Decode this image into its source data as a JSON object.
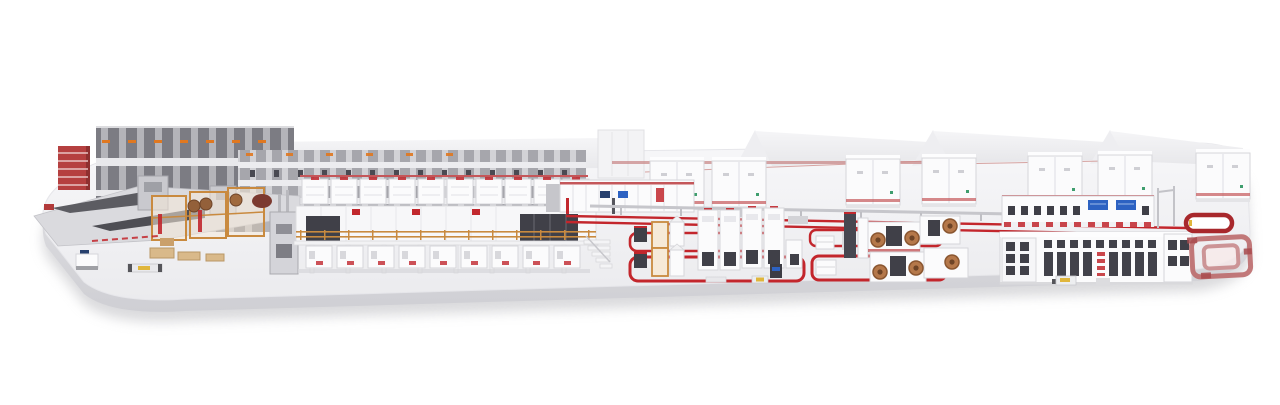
{
  "meta": {
    "description": "3D isometric render of a complete end-to-end industrial production line displayed on a white rounded platform",
    "background": "#ffffff"
  },
  "colors": {
    "platform_top": "#f3f3f5",
    "platform_side": "#e0e0e4",
    "platform_shadow": "#b5b5ba",
    "machine_white": "#fbfbfc",
    "machine_outline": "#d6d6da",
    "panel_dark": "#404048",
    "accent_red": "#c1272d",
    "muted_red": "#c4575a",
    "floor_red": "#c3262c",
    "rack_dark": "#84848a",
    "rack_light": "#b4b4b9",
    "scaffold_orange": "#c98a3f",
    "wood_tan": "#d9b98a",
    "roll_brown": "#93603a",
    "coil_copper": "#b5784a",
    "screen_blue": "#2d62c2",
    "navy": "#27406e",
    "agv_yellow": "#e0b63c",
    "roof_light": "#f0f0f3",
    "steel_gray": "#c9c9ce",
    "green_dot": "#3f9e6e"
  },
  "scene": {
    "sections": [
      {
        "label": "white display platform"
      },
      {
        "label": "tall storage rack towers"
      },
      {
        "label": "red supply rack"
      },
      {
        "label": "flat feeding table with conveyor ramps"
      },
      {
        "label": "orange-framed web handling module with rolls"
      },
      {
        "label": "elevated multi-deck process line"
      },
      {
        "label": "background factory roofs"
      },
      {
        "label": "utility cabinet row"
      },
      {
        "label": "control enclosure wall with screens"
      },
      {
        "label": "long transfer rails with red floor lines"
      },
      {
        "label": "assembly cell one with red AGV loops"
      },
      {
        "label": "winding cell with copper coils"
      },
      {
        "label": "finishing and packing hall"
      },
      {
        "label": "red return conveyor loop"
      },
      {
        "label": "AGV shuttles"
      }
    ]
  }
}
